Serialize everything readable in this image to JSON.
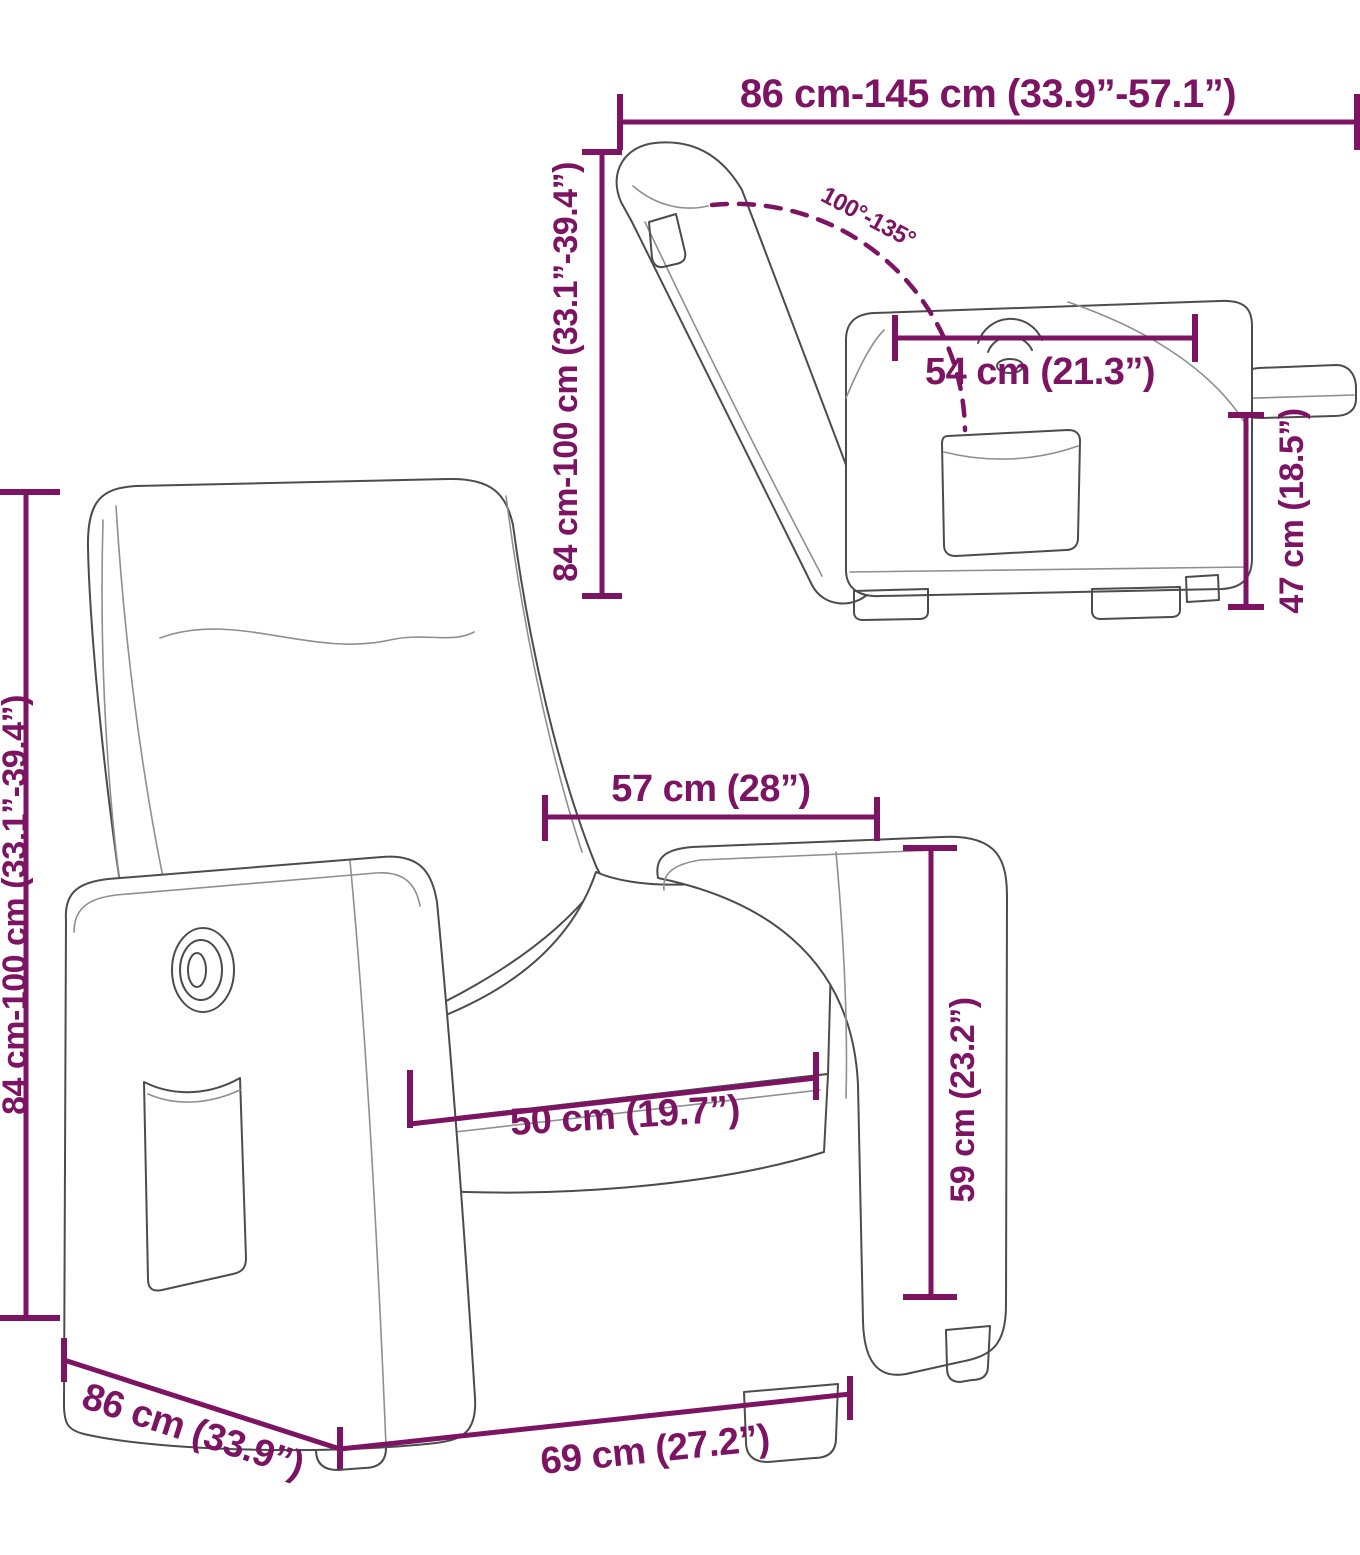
{
  "diagram": {
    "kind": "product dimension diagram",
    "views": [
      "reclined side view",
      "front three-quarter view"
    ],
    "colors": {
      "accent": "#7d1463",
      "drawing_line": "#4c4c4c",
      "background": "#ffffff"
    }
  },
  "labels": {
    "top_extension": "86 cm-145 cm (33.9”-57.1”)",
    "side_height": "84 cm-100 cm (33.1”-39.4”)",
    "recline_angle": "100°-135°",
    "side_seat_depth": "54 cm (21.3”)",
    "footrest_height": "47 cm (18.5”)",
    "front_height": "84 cm-100 cm (33.1”-39.4”)",
    "armrest_span": "57 cm (28”)",
    "seat_width": "50 cm (19.7”)",
    "seat_height": "59 cm (23.2”)",
    "base_depth": "86 cm (33.9”)",
    "base_width": "69 cm (27.2”)"
  }
}
